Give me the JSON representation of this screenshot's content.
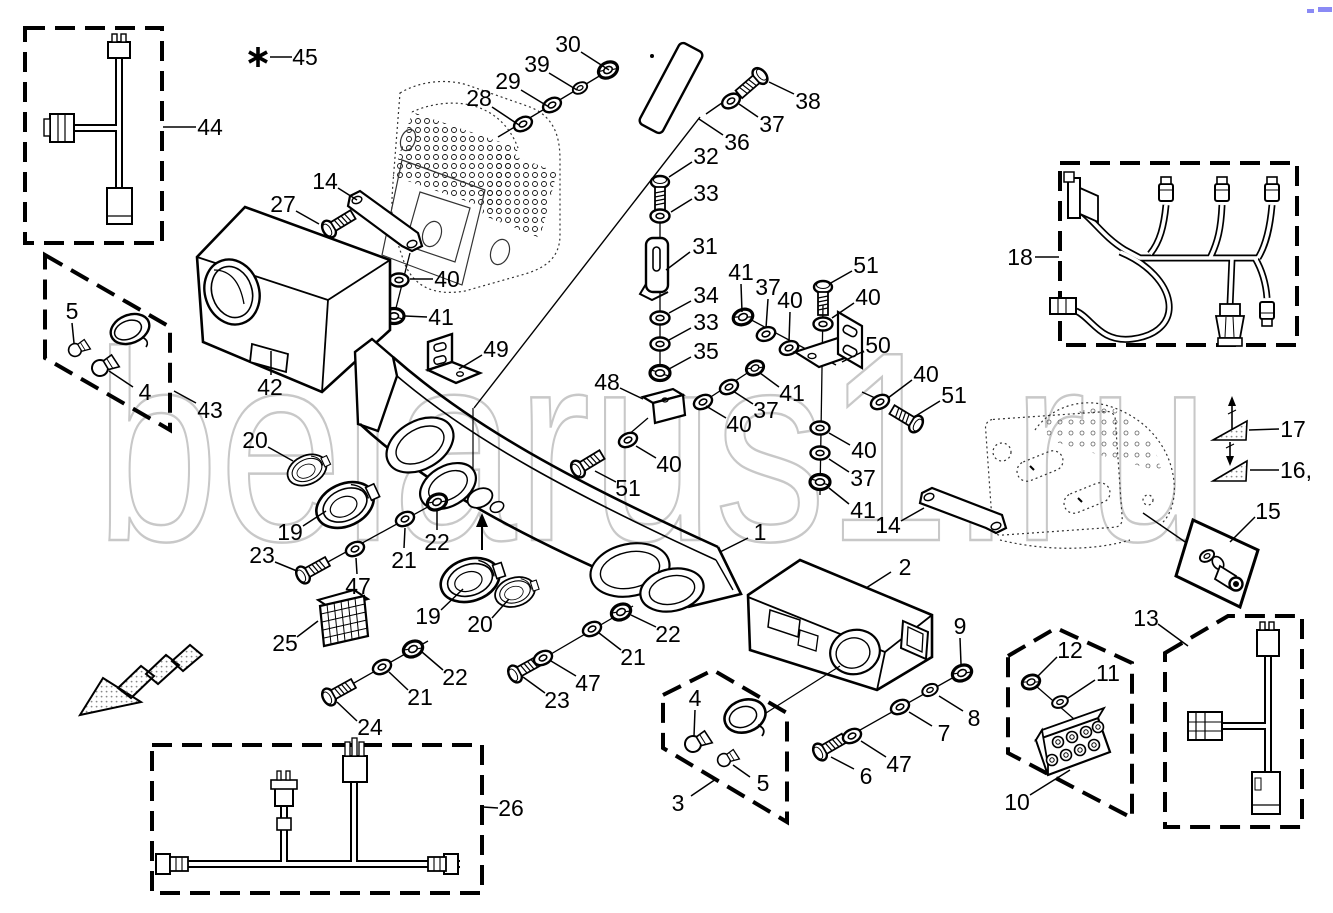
{
  "watermark": {
    "text": "belarus1.ru",
    "color": "#c8c8c8"
  },
  "artifact": {
    "color": "#8a8af5"
  },
  "callouts": [
    {
      "t": "44",
      "x": 210,
      "y": 127,
      "l": [
        163,
        127,
        196,
        127
      ]
    },
    {
      "t": "45",
      "x": 305,
      "y": 57,
      "l": [
        270,
        57,
        292,
        57
      ]
    },
    {
      "t": "30",
      "x": 568,
      "y": 44,
      "l": [
        581,
        52,
        609,
        70
      ]
    },
    {
      "t": "39",
      "x": 537,
      "y": 64,
      "l": [
        549,
        73,
        577,
        90
      ]
    },
    {
      "t": "29",
      "x": 508,
      "y": 81,
      "l": [
        521,
        90,
        549,
        107
      ]
    },
    {
      "t": "28",
      "x": 479,
      "y": 98,
      "l": [
        492,
        107,
        519,
        125
      ]
    },
    {
      "t": "38",
      "x": 808,
      "y": 101,
      "l": [
        794,
        94,
        769,
        82
      ]
    },
    {
      "t": "37",
      "x": 772,
      "y": 124,
      "l": [
        758,
        117,
        739,
        104
      ]
    },
    {
      "t": "36",
      "x": 737,
      "y": 142,
      "l": [
        723,
        135,
        699,
        119
      ]
    },
    {
      "t": "32",
      "x": 706,
      "y": 156,
      "l": [
        692,
        162,
        669,
        177
      ]
    },
    {
      "t": "33",
      "x": 706,
      "y": 193,
      "l": [
        692,
        199,
        671,
        212
      ]
    },
    {
      "t": "31",
      "x": 705,
      "y": 246,
      "l": [
        690,
        252,
        666,
        270
      ]
    },
    {
      "t": "34",
      "x": 706,
      "y": 295,
      "l": [
        691,
        301,
        669,
        313
      ]
    },
    {
      "t": "33",
      "x": 706,
      "y": 322,
      "l": [
        691,
        328,
        669,
        340
      ]
    },
    {
      "t": "35",
      "x": 706,
      "y": 351,
      "l": [
        691,
        357,
        669,
        369
      ]
    },
    {
      "t": "41",
      "x": 741,
      "y": 272,
      "l": [
        741,
        284,
        742,
        312
      ]
    },
    {
      "t": "37",
      "x": 768,
      "y": 287,
      "l": [
        768,
        299,
        766,
        328
      ]
    },
    {
      "t": "40",
      "x": 790,
      "y": 300,
      "l": [
        790,
        312,
        789,
        342
      ]
    },
    {
      "t": "51",
      "x": 866,
      "y": 265,
      "l": [
        852,
        271,
        829,
        284
      ]
    },
    {
      "t": "40",
      "x": 868,
      "y": 297,
      "l": [
        854,
        303,
        832,
        318
      ]
    },
    {
      "t": "50",
      "x": 878,
      "y": 345,
      "l": [
        864,
        351,
        842,
        362
      ]
    },
    {
      "t": "40",
      "x": 926,
      "y": 374,
      "l": [
        912,
        380,
        888,
        398
      ]
    },
    {
      "t": "51",
      "x": 954,
      "y": 395,
      "l": [
        940,
        401,
        914,
        417
      ]
    },
    {
      "t": "41",
      "x": 792,
      "y": 393,
      "l": [
        779,
        387,
        760,
        373
      ]
    },
    {
      "t": "37",
      "x": 766,
      "y": 410,
      "l": [
        753,
        404,
        733,
        391
      ]
    },
    {
      "t": "40",
      "x": 739,
      "y": 424,
      "l": [
        726,
        418,
        706,
        406
      ]
    },
    {
      "t": "40",
      "x": 864,
      "y": 450,
      "l": [
        850,
        445,
        829,
        433
      ]
    },
    {
      "t": "37",
      "x": 863,
      "y": 478,
      "l": [
        849,
        472,
        829,
        459
      ]
    },
    {
      "t": "41",
      "x": 863,
      "y": 510,
      "l": [
        849,
        504,
        829,
        488
      ]
    },
    {
      "t": "14",
      "x": 888,
      "y": 525,
      "l": [
        901,
        521,
        924,
        508
      ]
    },
    {
      "t": "17",
      "x": 1293,
      "y": 429,
      "l": [
        1279,
        429,
        1249,
        430
      ]
    },
    {
      "t": "16,",
      "x": 1296,
      "y": 470,
      "l": [
        1279,
        470,
        1250,
        470
      ]
    },
    {
      "t": "15",
      "x": 1268,
      "y": 511,
      "l": [
        1255,
        517,
        1230,
        542
      ]
    },
    {
      "t": "13",
      "x": 1146,
      "y": 618,
      "l": [
        1158,
        624,
        1188,
        646
      ]
    },
    {
      "t": "18",
      "x": 1020,
      "y": 257,
      "l": [
        1035,
        257,
        1059,
        257
      ]
    },
    {
      "t": "26",
      "x": 511,
      "y": 808,
      "l": [
        498,
        808,
        483,
        807
      ]
    },
    {
      "t": "10",
      "x": 1017,
      "y": 802,
      "l": [
        1030,
        795,
        1070,
        770
      ]
    },
    {
      "t": "12",
      "x": 1070,
      "y": 650,
      "l": [
        1057,
        657,
        1038,
        676
      ]
    },
    {
      "t": "11",
      "x": 1108,
      "y": 673,
      "l": [
        1095,
        680,
        1068,
        698
      ]
    },
    {
      "t": "9",
      "x": 960,
      "y": 626,
      "l": [
        960,
        638,
        961,
        664
      ]
    },
    {
      "t": "8",
      "x": 974,
      "y": 718,
      "l": [
        963,
        711,
        939,
        696
      ]
    },
    {
      "t": "7",
      "x": 944,
      "y": 733,
      "l": [
        932,
        726,
        909,
        712
      ]
    },
    {
      "t": "47",
      "x": 899,
      "y": 764,
      "l": [
        886,
        757,
        861,
        741
      ]
    },
    {
      "t": "6",
      "x": 866,
      "y": 776,
      "l": [
        854,
        769,
        831,
        757
      ]
    },
    {
      "t": "2",
      "x": 905,
      "y": 567,
      "l": [
        891,
        572,
        866,
        588
      ]
    },
    {
      "t": "3",
      "x": 678,
      "y": 803,
      "l": [
        691,
        796,
        716,
        779
      ]
    },
    {
      "t": "4",
      "x": 695,
      "y": 698,
      "l": [
        695,
        710,
        694,
        736
      ]
    },
    {
      "t": "5",
      "x": 763,
      "y": 783,
      "l": [
        750,
        777,
        733,
        765
      ]
    },
    {
      "t": "5",
      "x": 72,
      "y": 311,
      "l": [
        72,
        323,
        74,
        343
      ]
    },
    {
      "t": "4",
      "x": 145,
      "y": 392,
      "l": [
        133,
        387,
        109,
        371
      ]
    },
    {
      "t": "43",
      "x": 210,
      "y": 410,
      "l": [
        196,
        403,
        174,
        391
      ]
    },
    {
      "t": "20",
      "x": 255,
      "y": 440,
      "l": [
        268,
        447,
        293,
        461
      ]
    },
    {
      "t": "19",
      "x": 290,
      "y": 532,
      "l": [
        303,
        526,
        326,
        511
      ]
    },
    {
      "t": "23",
      "x": 262,
      "y": 555,
      "l": [
        275,
        562,
        297,
        571
      ]
    },
    {
      "t": "47",
      "x": 358,
      "y": 586,
      "l": [
        357,
        574,
        356,
        558
      ]
    },
    {
      "t": "21",
      "x": 404,
      "y": 560,
      "l": [
        404,
        548,
        405,
        528
      ]
    },
    {
      "t": "22",
      "x": 437,
      "y": 542,
      "l": [
        437,
        530,
        437,
        510
      ]
    },
    {
      "t": "25",
      "x": 285,
      "y": 643,
      "l": [
        297,
        637,
        318,
        621
      ]
    },
    {
      "t": "24",
      "x": 370,
      "y": 727,
      "l": [
        357,
        721,
        337,
        702
      ]
    },
    {
      "t": "21",
      "x": 420,
      "y": 697,
      "l": [
        408,
        690,
        389,
        672
      ]
    },
    {
      "t": "22",
      "x": 455,
      "y": 677,
      "l": [
        443,
        670,
        422,
        652
      ]
    },
    {
      "t": "23",
      "x": 557,
      "y": 700,
      "l": [
        545,
        693,
        523,
        677
      ]
    },
    {
      "t": "47",
      "x": 588,
      "y": 683,
      "l": [
        576,
        676,
        551,
        661
      ]
    },
    {
      "t": "21",
      "x": 633,
      "y": 657,
      "l": [
        621,
        650,
        599,
        633
      ]
    },
    {
      "t": "22",
      "x": 668,
      "y": 634,
      "l": [
        656,
        627,
        631,
        615
      ]
    },
    {
      "t": "19",
      "x": 428,
      "y": 616,
      "l": [
        441,
        610,
        463,
        589
      ]
    },
    {
      "t": "20",
      "x": 480,
      "y": 624,
      "l": [
        492,
        618,
        509,
        599
      ]
    },
    {
      "t": "1",
      "x": 760,
      "y": 532,
      "l": [
        748,
        538,
        720,
        552
      ]
    },
    {
      "t": "49",
      "x": 496,
      "y": 349,
      "l": [
        482,
        355,
        459,
        369
      ]
    },
    {
      "t": "48",
      "x": 607,
      "y": 382,
      "l": [
        620,
        388,
        643,
        399
      ]
    },
    {
      "t": "40",
      "x": 669,
      "y": 464,
      "l": [
        656,
        458,
        636,
        446
      ]
    },
    {
      "t": "51",
      "x": 628,
      "y": 488,
      "l": [
        616,
        482,
        595,
        471
      ]
    },
    {
      "t": "42",
      "x": 270,
      "y": 387,
      "l": [
        271,
        375,
        271,
        351
      ]
    },
    {
      "t": "27",
      "x": 283,
      "y": 204,
      "l": [
        296,
        211,
        319,
        224
      ]
    },
    {
      "t": "14",
      "x": 325,
      "y": 181,
      "l": [
        338,
        188,
        357,
        200
      ]
    },
    {
      "t": "40",
      "x": 447,
      "y": 279,
      "l": [
        433,
        279,
        410,
        279
      ]
    },
    {
      "t": "41",
      "x": 441,
      "y": 317,
      "l": [
        427,
        317,
        405,
        316
      ]
    }
  ]
}
